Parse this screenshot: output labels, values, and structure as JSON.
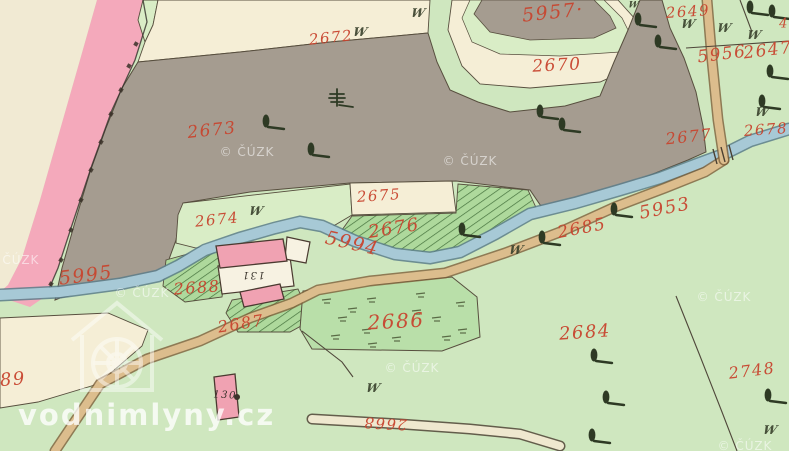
{
  "watermarks": {
    "copyright": "© ČÚZK",
    "site": "vodnimlyny.cz"
  },
  "cuzk_positions": [
    {
      "x": 247,
      "y": 152
    },
    {
      "x": 470,
      "y": 161
    },
    {
      "x": 12,
      "y": 260
    },
    {
      "x": 142,
      "y": 293
    },
    {
      "x": 412,
      "y": 368
    },
    {
      "x": 724,
      "y": 297
    },
    {
      "x": 745,
      "y": 446
    }
  ],
  "labels": [
    {
      "t": "2672",
      "x": 331,
      "y": 38,
      "r": -6,
      "s": 15
    },
    {
      "t": "5957·",
      "x": 553,
      "y": 13,
      "r": -6,
      "s": 19
    },
    {
      "t": "2649",
      "x": 688,
      "y": 12,
      "r": -4,
      "s": 15
    },
    {
      "t": "2670",
      "x": 557,
      "y": 66,
      "r": -3,
      "s": 17
    },
    {
      "t": "5956",
      "x": 722,
      "y": 55,
      "r": -7,
      "s": 17
    },
    {
      "t": "2647",
      "x": 768,
      "y": 51,
      "r": -7,
      "s": 17
    },
    {
      "t": "4",
      "x": 784,
      "y": 24,
      "r": 0,
      "s": 13
    },
    {
      "t": "2673",
      "x": 212,
      "y": 131,
      "r": -6,
      "s": 17
    },
    {
      "t": "2677",
      "x": 689,
      "y": 137,
      "r": -6,
      "s": 16
    },
    {
      "t": "2678",
      "x": 766,
      "y": 130,
      "r": -4,
      "s": 15
    },
    {
      "t": "2675",
      "x": 379,
      "y": 196,
      "r": -4,
      "s": 15
    },
    {
      "t": "2674",
      "x": 217,
      "y": 220,
      "r": -6,
      "s": 15
    },
    {
      "t": "2676",
      "x": 394,
      "y": 229,
      "r": -9,
      "s": 18
    },
    {
      "t": "5994",
      "x": 352,
      "y": 244,
      "r": 13,
      "s": 19
    },
    {
      "t": "2685",
      "x": 582,
      "y": 229,
      "r": -11,
      "s": 17
    },
    {
      "t": "5953",
      "x": 665,
      "y": 209,
      "r": -11,
      "s": 18
    },
    {
      "t": "5995",
      "x": 86,
      "y": 276,
      "r": -7,
      "s": 19
    },
    {
      "t": "2688",
      "x": 197,
      "y": 288,
      "r": -4,
      "s": 16
    },
    {
      "t": "2687",
      "x": 241,
      "y": 324,
      "r": -9,
      "s": 16
    },
    {
      "t": "2686",
      "x": 396,
      "y": 321,
      "r": -3,
      "s": 20
    },
    {
      "t": "2684",
      "x": 585,
      "y": 333,
      "r": -4,
      "s": 18
    },
    {
      "t": "2748",
      "x": 752,
      "y": 371,
      "r": -7,
      "s": 16
    },
    {
      "t": "89",
      "x": 13,
      "y": 380,
      "r": -5,
      "s": 18
    },
    {
      "t": "2668",
      "x": 385,
      "y": 423,
      "r": 183,
      "s": 15
    },
    {
      "t": "131",
      "x": 253,
      "y": 274,
      "r": 180,
      "s": 10,
      "c": "#332e26"
    },
    {
      "t": "130",
      "x": 225,
      "y": 396,
      "r": 3,
      "s": 10,
      "c": "#332e26"
    }
  ],
  "meadow_symbol": "W",
  "meadow_marks": [
    {
      "x": 418,
      "y": 13
    },
    {
      "x": 360,
      "y": 32
    },
    {
      "x": 688,
      "y": 24
    },
    {
      "x": 724,
      "y": 28
    },
    {
      "x": 754,
      "y": 35
    },
    {
      "x": 762,
      "y": 112
    },
    {
      "x": 256,
      "y": 211
    },
    {
      "x": 516,
      "y": 250
    },
    {
      "x": 373,
      "y": 388
    },
    {
      "x": 770,
      "y": 430
    },
    {
      "x": 633,
      "y": 6,
      "s": 9
    }
  ],
  "trees": [
    {
      "x": 266,
      "y": 122
    },
    {
      "x": 311,
      "y": 150
    },
    {
      "x": 540,
      "y": 112
    },
    {
      "x": 562,
      "y": 125
    },
    {
      "x": 638,
      "y": 20
    },
    {
      "x": 658,
      "y": 42
    },
    {
      "x": 750,
      "y": 8
    },
    {
      "x": 772,
      "y": 12
    },
    {
      "x": 770,
      "y": 72
    },
    {
      "x": 762,
      "y": 102
    },
    {
      "x": 462,
      "y": 230
    },
    {
      "x": 614,
      "y": 210
    },
    {
      "x": 542,
      "y": 238
    },
    {
      "x": 594,
      "y": 356
    },
    {
      "x": 606,
      "y": 398
    },
    {
      "x": 592,
      "y": 436
    },
    {
      "x": 768,
      "y": 396
    },
    {
      "x": 333,
      "y": 97,
      "k": "c"
    }
  ],
  "boundary_dots": [
    [
      136,
      44
    ],
    [
      129,
      66
    ],
    [
      121,
      90
    ],
    [
      111,
      114
    ],
    [
      101,
      142
    ],
    [
      91,
      170
    ],
    [
      81,
      200
    ],
    [
      71,
      230
    ],
    [
      61,
      260
    ],
    [
      51,
      284
    ]
  ],
  "colors": {
    "base_green": "#cfe7bf",
    "margin_cream": "#f1ead3",
    "field_cream": "#f5eed6",
    "pink_zone": "#f4a9bb",
    "gray_parcel": "#a59c90",
    "inner_green": "#d9edc6",
    "hatch_green": "#aed99c",
    "hatch_line": "#44713c",
    "scrub_green": "#b9dfa9",
    "stream_fill": "#a7c9d6",
    "stream_edge": "#5a7d89",
    "road_fill": "#dcbd8d",
    "road_edge": "#7d5f3a",
    "building_pink": "#f0a2b2",
    "building_white": "#f7f2e2",
    "outline_dark": "#574e3e",
    "label_red": "#c8452f",
    "symbol_ink": "#39412c",
    "tree_ink": "#2e3a24",
    "dot_ink": "#3a3128"
  }
}
